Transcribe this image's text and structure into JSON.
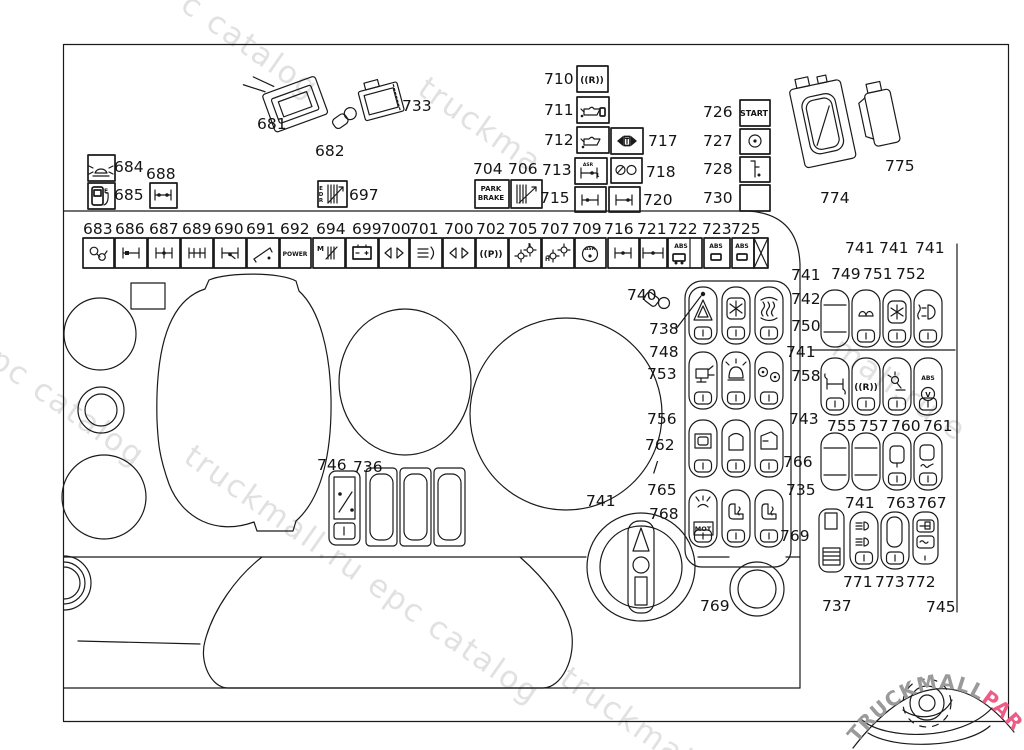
{
  "watermark": {
    "color": "#c9c9c9",
    "instances": [
      {
        "text": "c catalog",
        "x": 195,
        "y": -14,
        "s": 31
      },
      {
        "text": "truckma",
        "x": 432,
        "y": 70,
        "s": 31
      },
      {
        "text": "l epc catalog",
        "x": -32,
        "y": 316,
        "s": 31
      },
      {
        "text": "truckmall.ru epc catalog",
        "x": 198,
        "y": 438,
        "s": 31
      },
      {
        "text": "mall.ru e",
        "x": 846,
        "y": 330,
        "s": 31
      },
      {
        "text": "truckmall",
        "x": 574,
        "y": 660,
        "s": 31
      }
    ]
  },
  "logo": {
    "line1": "TRUCKMALL",
    "line2": "PARTS",
    "grey": "#9a9a9a",
    "pink": "#ee5c86"
  },
  "labels": [
    {
      "t": "681",
      "x": 257,
      "y": 129
    },
    {
      "t": "682",
      "x": 315,
      "y": 156
    },
    {
      "t": "733",
      "x": 402,
      "y": 111
    },
    {
      "t": "684",
      "x": 114,
      "y": 172
    },
    {
      "t": "688",
      "x": 146,
      "y": 179
    },
    {
      "t": "685",
      "x": 114,
      "y": 200
    },
    {
      "t": "697",
      "x": 349,
      "y": 200
    },
    {
      "t": "710",
      "x": 544,
      "y": 84
    },
    {
      "t": "711",
      "x": 544,
      "y": 115
    },
    {
      "t": "712",
      "x": 544,
      "y": 145
    },
    {
      "t": "717",
      "x": 648,
      "y": 146
    },
    {
      "t": "704",
      "x": 473,
      "y": 174
    },
    {
      "t": "706",
      "x": 508,
      "y": 174
    },
    {
      "t": "713",
      "x": 542,
      "y": 175
    },
    {
      "t": "718",
      "x": 646,
      "y": 177
    },
    {
      "t": "715",
      "x": 540,
      "y": 203
    },
    {
      "t": "720",
      "x": 643,
      "y": 205
    },
    {
      "t": "726",
      "x": 703,
      "y": 117
    },
    {
      "t": "727",
      "x": 703,
      "y": 146
    },
    {
      "t": "728",
      "x": 703,
      "y": 174
    },
    {
      "t": "730",
      "x": 703,
      "y": 203
    },
    {
      "t": "774",
      "x": 820,
      "y": 203
    },
    {
      "t": "775",
      "x": 885,
      "y": 171
    },
    {
      "t": "683",
      "x": 83,
      "y": 234
    },
    {
      "t": "686",
      "x": 115,
      "y": 234
    },
    {
      "t": "687",
      "x": 149,
      "y": 234
    },
    {
      "t": "689",
      "x": 182,
      "y": 234
    },
    {
      "t": "690",
      "x": 214,
      "y": 234
    },
    {
      "t": "691",
      "x": 246,
      "y": 234
    },
    {
      "t": "692",
      "x": 280,
      "y": 234
    },
    {
      "t": "694",
      "x": 316,
      "y": 234
    },
    {
      "t": "699",
      "x": 352,
      "y": 234
    },
    {
      "t": "700",
      "x": 381,
      "y": 234
    },
    {
      "t": "701",
      "x": 409,
      "y": 234
    },
    {
      "t": "700",
      "x": 444,
      "y": 234
    },
    {
      "t": "702",
      "x": 476,
      "y": 234
    },
    {
      "t": "705",
      "x": 508,
      "y": 234
    },
    {
      "t": "707",
      "x": 540,
      "y": 234
    },
    {
      "t": "709",
      "x": 572,
      "y": 234
    },
    {
      "t": "716",
      "x": 604,
      "y": 234
    },
    {
      "t": "721",
      "x": 637,
      "y": 234
    },
    {
      "t": "722",
      "x": 668,
      "y": 234
    },
    {
      "t": "723",
      "x": 702,
      "y": 234
    },
    {
      "t": "725",
      "x": 731,
      "y": 234
    },
    {
      "t": "740",
      "x": 627,
      "y": 300
    },
    {
      "t": "741",
      "x": 791,
      "y": 280
    },
    {
      "t": "738",
      "x": 649,
      "y": 334
    },
    {
      "t": "742",
      "x": 791,
      "y": 304
    },
    {
      "t": "748",
      "x": 649,
      "y": 357
    },
    {
      "t": "750",
      "x": 791,
      "y": 331
    },
    {
      "t": "753",
      "x": 647,
      "y": 379
    },
    {
      "t": "741",
      "x": 786,
      "y": 357
    },
    {
      "t": "758",
      "x": 791,
      "y": 381
    },
    {
      "t": "756",
      "x": 647,
      "y": 424
    },
    {
      "t": "762",
      "x": 645,
      "y": 450
    },
    {
      "t": "/",
      "x": 653,
      "y": 472
    },
    {
      "t": "743",
      "x": 789,
      "y": 424
    },
    {
      "t": "766",
      "x": 783,
      "y": 467
    },
    {
      "t": "765",
      "x": 647,
      "y": 495
    },
    {
      "t": "741",
      "x": 586,
      "y": 506
    },
    {
      "t": "768",
      "x": 649,
      "y": 519
    },
    {
      "t": "735",
      "x": 786,
      "y": 495
    },
    {
      "t": "769",
      "x": 780,
      "y": 541
    },
    {
      "t": "769",
      "x": 700,
      "y": 611
    },
    {
      "t": "741",
      "x": 845,
      "y": 253
    },
    {
      "t": "741",
      "x": 879,
      "y": 253
    },
    {
      "t": "741",
      "x": 915,
      "y": 253
    },
    {
      "t": "749",
      "x": 831,
      "y": 279
    },
    {
      "t": "751",
      "x": 863,
      "y": 279
    },
    {
      "t": "752",
      "x": 896,
      "y": 279
    },
    {
      "t": "755",
      "x": 827,
      "y": 431
    },
    {
      "t": "757",
      "x": 859,
      "y": 431
    },
    {
      "t": "760",
      "x": 891,
      "y": 431
    },
    {
      "t": "761",
      "x": 923,
      "y": 431
    },
    {
      "t": "741",
      "x": 845,
      "y": 508
    },
    {
      "t": "763",
      "x": 886,
      "y": 508
    },
    {
      "t": "767",
      "x": 917,
      "y": 508
    },
    {
      "t": "771",
      "x": 843,
      "y": 587
    },
    {
      "t": "773",
      "x": 875,
      "y": 587
    },
    {
      "t": "772",
      "x": 906,
      "y": 587
    },
    {
      "t": "737",
      "x": 822,
      "y": 611
    },
    {
      "t": "745",
      "x": 926,
      "y": 612
    },
    {
      "t": "746",
      "x": 317,
      "y": 470
    },
    {
      "t": "736",
      "x": 353,
      "y": 472
    }
  ],
  "icon_texts": [
    {
      "t": "START",
      "x": 754,
      "y": 116,
      "s": 8,
      "a": "middle"
    },
    {
      "t": "PARK",
      "x": 491,
      "y": 191,
      "s": 7,
      "a": "middle"
    },
    {
      "t": "BRAKE",
      "x": 491,
      "y": 200,
      "s": 7,
      "a": "middle"
    },
    {
      "t": "POWER",
      "x": 295,
      "y": 256,
      "s": 6,
      "a": "middle"
    },
    {
      "t": "M",
      "x": 317,
      "y": 251,
      "s": 7,
      "a": "start"
    },
    {
      "t": "E",
      "x": 321,
      "y": 190,
      "s": 5.5,
      "a": "middle"
    },
    {
      "t": "D",
      "x": 321,
      "y": 196,
      "s": 5.5,
      "a": "middle"
    },
    {
      "t": "R",
      "x": 321,
      "y": 202,
      "s": 5.5,
      "a": "middle"
    },
    {
      "t": "E",
      "x": 104,
      "y": 193,
      "s": 6,
      "a": "start"
    },
    {
      "t": "((P))",
      "x": 491,
      "y": 257,
      "s": 9,
      "a": "middle"
    },
    {
      "t": "((R))",
      "x": 592,
      "y": 83,
      "s": 9,
      "a": "middle"
    },
    {
      "t": "((R))",
      "x": 866,
      "y": 390,
      "s": 9,
      "a": "middle"
    },
    {
      "t": "ABS",
      "x": 681,
      "y": 248,
      "s": 6,
      "a": "middle"
    },
    {
      "t": "ABS",
      "x": 716,
      "y": 248,
      "s": 6,
      "a": "middle"
    },
    {
      "t": "ABS",
      "x": 742,
      "y": 248,
      "s": 6,
      "a": "middle"
    },
    {
      "t": "ABS",
      "x": 928,
      "y": 380,
      "s": 6,
      "a": "middle"
    },
    {
      "t": "V",
      "x": 928,
      "y": 397,
      "s": 7,
      "a": "middle"
    },
    {
      "t": "ASR",
      "x": 588,
      "y": 166,
      "s": 4.5,
      "a": "middle"
    },
    {
      "t": "1",
      "x": 596,
      "y": 177,
      "s": 5,
      "a": "start"
    },
    {
      "t": "ASR",
      "x": 590,
      "y": 250,
      "s": 4.5,
      "a": "middle"
    },
    {
      "t": "MOT",
      "x": 703,
      "y": 531,
      "s": 6.5,
      "a": "middle"
    },
    {
      "t": "L",
      "x": 528,
      "y": 247,
      "s": 5.5,
      "a": "start"
    },
    {
      "t": "H",
      "x": 545,
      "y": 261,
      "s": 6,
      "a": "start"
    }
  ]
}
